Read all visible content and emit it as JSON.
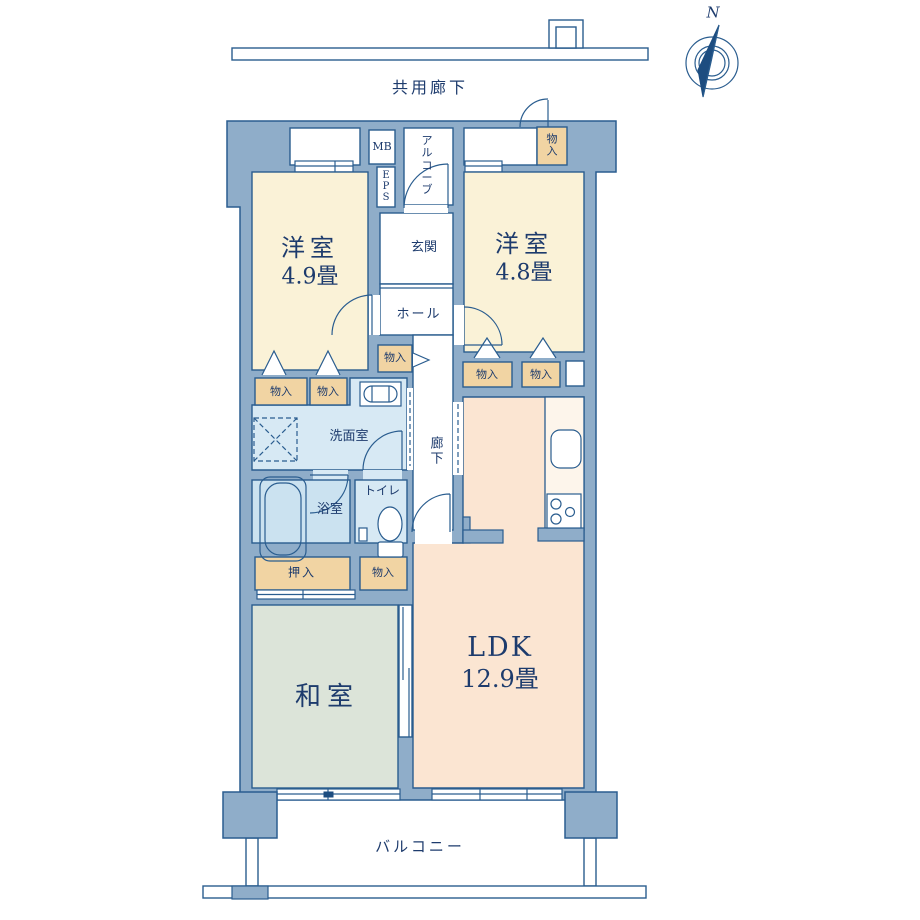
{
  "title": "マンション間取り図 (apartment floor plan)",
  "colors": {
    "wall": "#8fadc9",
    "outline": "#2a5d8f",
    "text": "#1d3b6d",
    "western_room": "#faf2d7",
    "ldk": "#fbe5d2",
    "japanese_room": "#dce4d9",
    "wet_area": "#d7e9f4",
    "closet": "#f1d4a3",
    "background": "#ffffff"
  },
  "compass": {
    "north": "N"
  },
  "exterior": {
    "common_corridor": "共用廊下",
    "balcony": "バルコニー"
  },
  "rooms": {
    "western1": {
      "name": "洋室",
      "size": "4.9畳"
    },
    "western2": {
      "name": "洋室",
      "size": "4.8畳"
    },
    "ldk": {
      "name": "LDK",
      "size": "12.9畳"
    },
    "japanese": {
      "name": "和室"
    },
    "entrance": {
      "name": "玄関"
    },
    "hall": {
      "name": "ホール"
    },
    "corridor": {
      "name": "廊下"
    },
    "washroom": {
      "name": "洗面室"
    },
    "bath": {
      "name": "浴室"
    },
    "toilet": {
      "name": "トイレ"
    },
    "alcove": {
      "name": "アルコーブ"
    },
    "meter_box": {
      "name": "MB"
    },
    "eps": {
      "name": "EPS"
    }
  },
  "storage": {
    "monoiri": "物入",
    "oshiire": "押入"
  }
}
